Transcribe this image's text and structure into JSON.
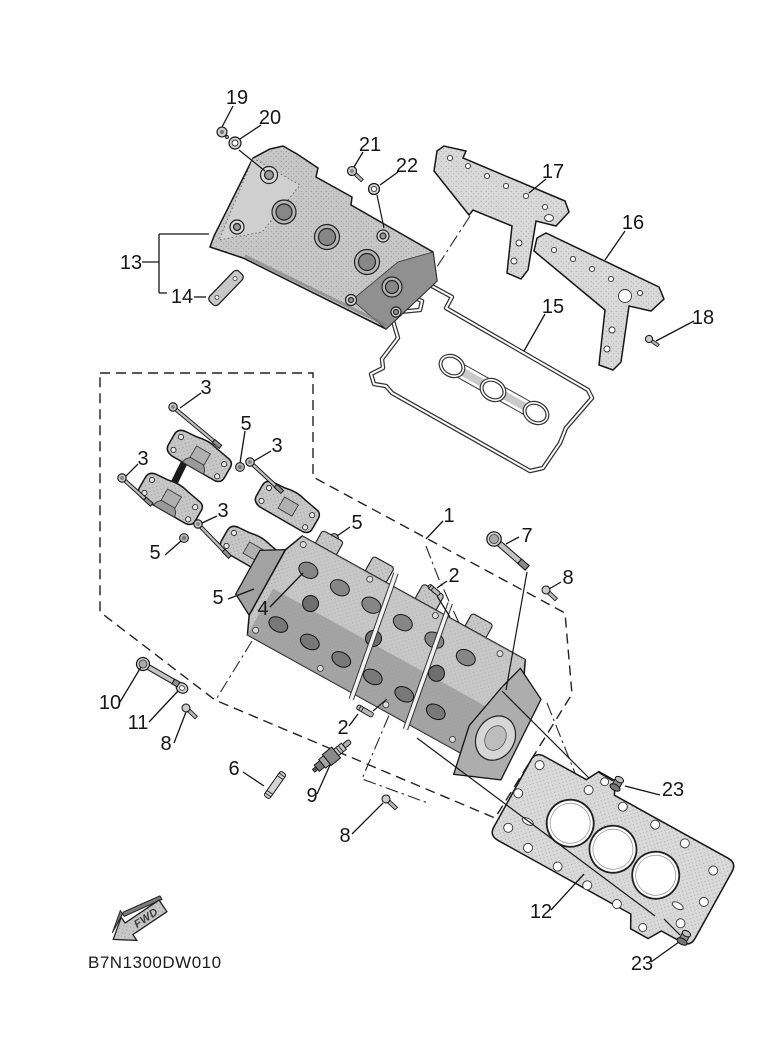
{
  "diagram": {
    "code": "B7N1300DW010",
    "fwd_label": "FWD",
    "callouts": [
      "19",
      "20",
      "21",
      "22",
      "17",
      "16",
      "13",
      "14",
      "15",
      "18",
      "3",
      "5",
      "3",
      "3",
      "1",
      "7",
      "3",
      "5",
      "2",
      "8",
      "5",
      "5",
      "4",
      "10",
      "11",
      "8",
      "2",
      "6",
      "9",
      "8",
      "12",
      "23",
      "23"
    ]
  }
}
